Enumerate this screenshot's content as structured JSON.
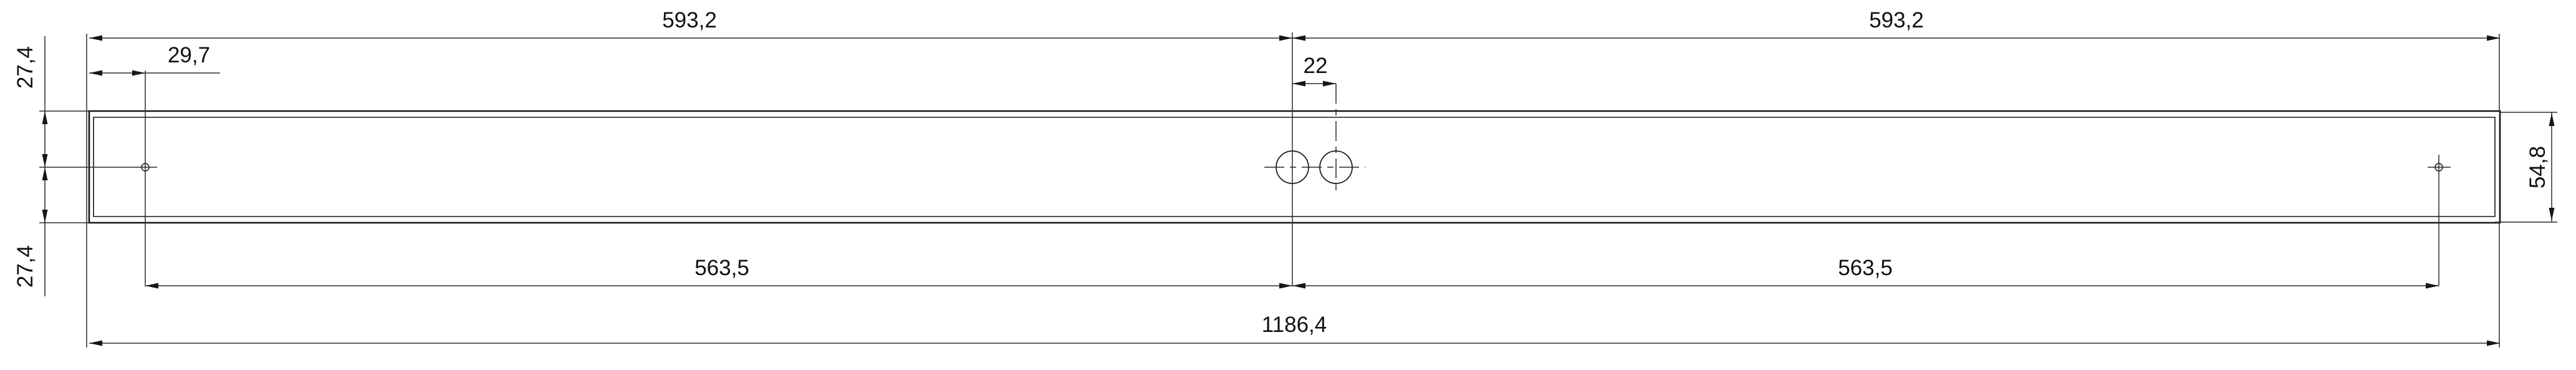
{
  "drawing": {
    "type": "technical-dimensioned-drawing",
    "decimal_style": "comma",
    "colors": {
      "line": "#161616",
      "background": "#ffffff"
    },
    "dimensions": {
      "top_span_left": "593,2",
      "top_span_right": "593,2",
      "left_offset_top": "27,4",
      "left_offset_bottom": "27,4",
      "end_hole_offset": "29,7",
      "center_holes_spacing": "22",
      "bottom_span_left": "563,5",
      "bottom_span_right": "563,5",
      "overall_length": "1186,4",
      "profile_height": "54,8"
    }
  }
}
